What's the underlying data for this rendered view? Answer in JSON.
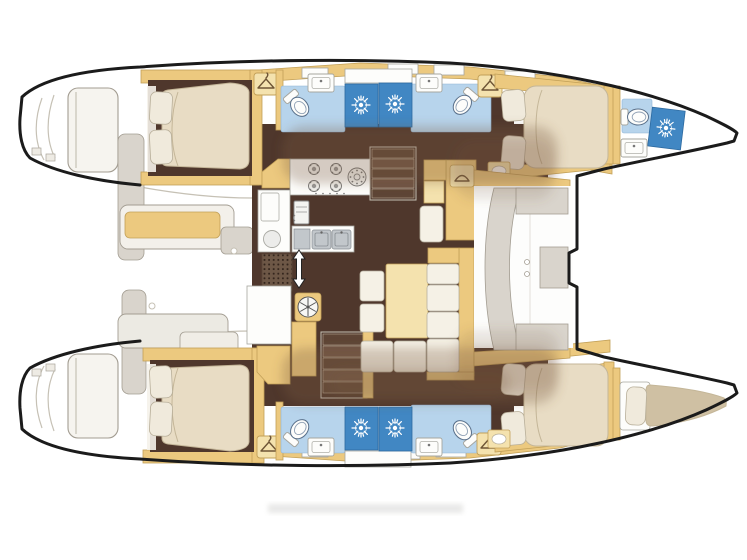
{
  "meta": {
    "title": "Catamaran yacht accommodation floor plan",
    "view": "top-down deck plan, bows pointing right",
    "visible_text": []
  },
  "colors": {
    "page_bg": "#ffffff",
    "outline": "#1b1b1b",
    "faint": "#c6c1b5",
    "wood": "#ecc97f",
    "wood_edge": "#c2a058",
    "wood_light": "#f4e2ae",
    "floor": "#4f372c",
    "wash": "#7b5a3f",
    "mattress": "#e8dcc4",
    "mattress_edge": "#c4b698",
    "berth": "#cfc0a3",
    "pillow": "#f0eadc",
    "pillow_edge": "#b8af9a",
    "cushion": "#f5f1e6",
    "cushion_edge": "#b7b1a1",
    "tile": "#b7d4ec",
    "tile_edge": "#8fb3d5",
    "shower": "#4187c3",
    "shower_edge": "#2d6aa0",
    "fixture": "#fdfdfb",
    "fixture_edge": "#a6a69f",
    "panel": "#d9d4cc",
    "panel_edge": "#a39d92",
    "steel": "#c2c7cb",
    "steel_edge": "#878d92",
    "icon": "#6e5536",
    "step_a": "#5e4536",
    "step_b": "#6f5444",
    "sun": "#ffffff"
  },
  "vessel": {
    "type": "sailing catamaran",
    "hulls": 2,
    "double_cabins": 4,
    "heads_with_shower": 4,
    "forepeak_compartments": [
      "bow head with toilet and shower (port bow)",
      "single crew berth (starboard bow)"
    ]
  },
  "features": {
    "port_hull": [
      "aft double cabin with pillows",
      "aft head: toilet, sink, shower stall",
      "forward head: shower stall, sink, toilet, wardrobe",
      "forward double cabin",
      "forepeak head: toilet, shower, sink"
    ],
    "starboard_hull": [
      "aft double cabin with pillows",
      "aft head: toilet, sink, shower stall",
      "forward head: shower stall, sink, toilet, wardrobe",
      "forward double cabin",
      "forepeak single berth"
    ],
    "bridgedeck": [
      "galley with 4-burner stove, round burner, twin sinks, fridge, floor grating",
      "port companionway stairs",
      "starboard companionway stairs",
      "nav station with seat",
      "U-shaped settee with table and two stools",
      "forward cockpit with curved seat",
      "trampoline deck with notched forward beam",
      "aft cockpit with bench seating",
      "twin transom steps"
    ],
    "icons": [
      {
        "name": "sunburst-shower-icon",
        "meaning": "shower rose / drain"
      },
      {
        "name": "toilet-icon",
        "meaning": "marine toilet"
      },
      {
        "name": "sink-icon",
        "meaning": "wash basin"
      },
      {
        "name": "hanger-icon",
        "meaning": "wardrobe / hanging locker"
      },
      {
        "name": "stove-burners-icon",
        "meaning": "galley cooktop"
      },
      {
        "name": "fan-hatch-icon",
        "meaning": "round hatch / vent"
      },
      {
        "name": "up-down-arrow-icon",
        "meaning": "companionway direction"
      },
      {
        "name": "fridge-icon",
        "meaning": "refrigerator"
      }
    ]
  }
}
